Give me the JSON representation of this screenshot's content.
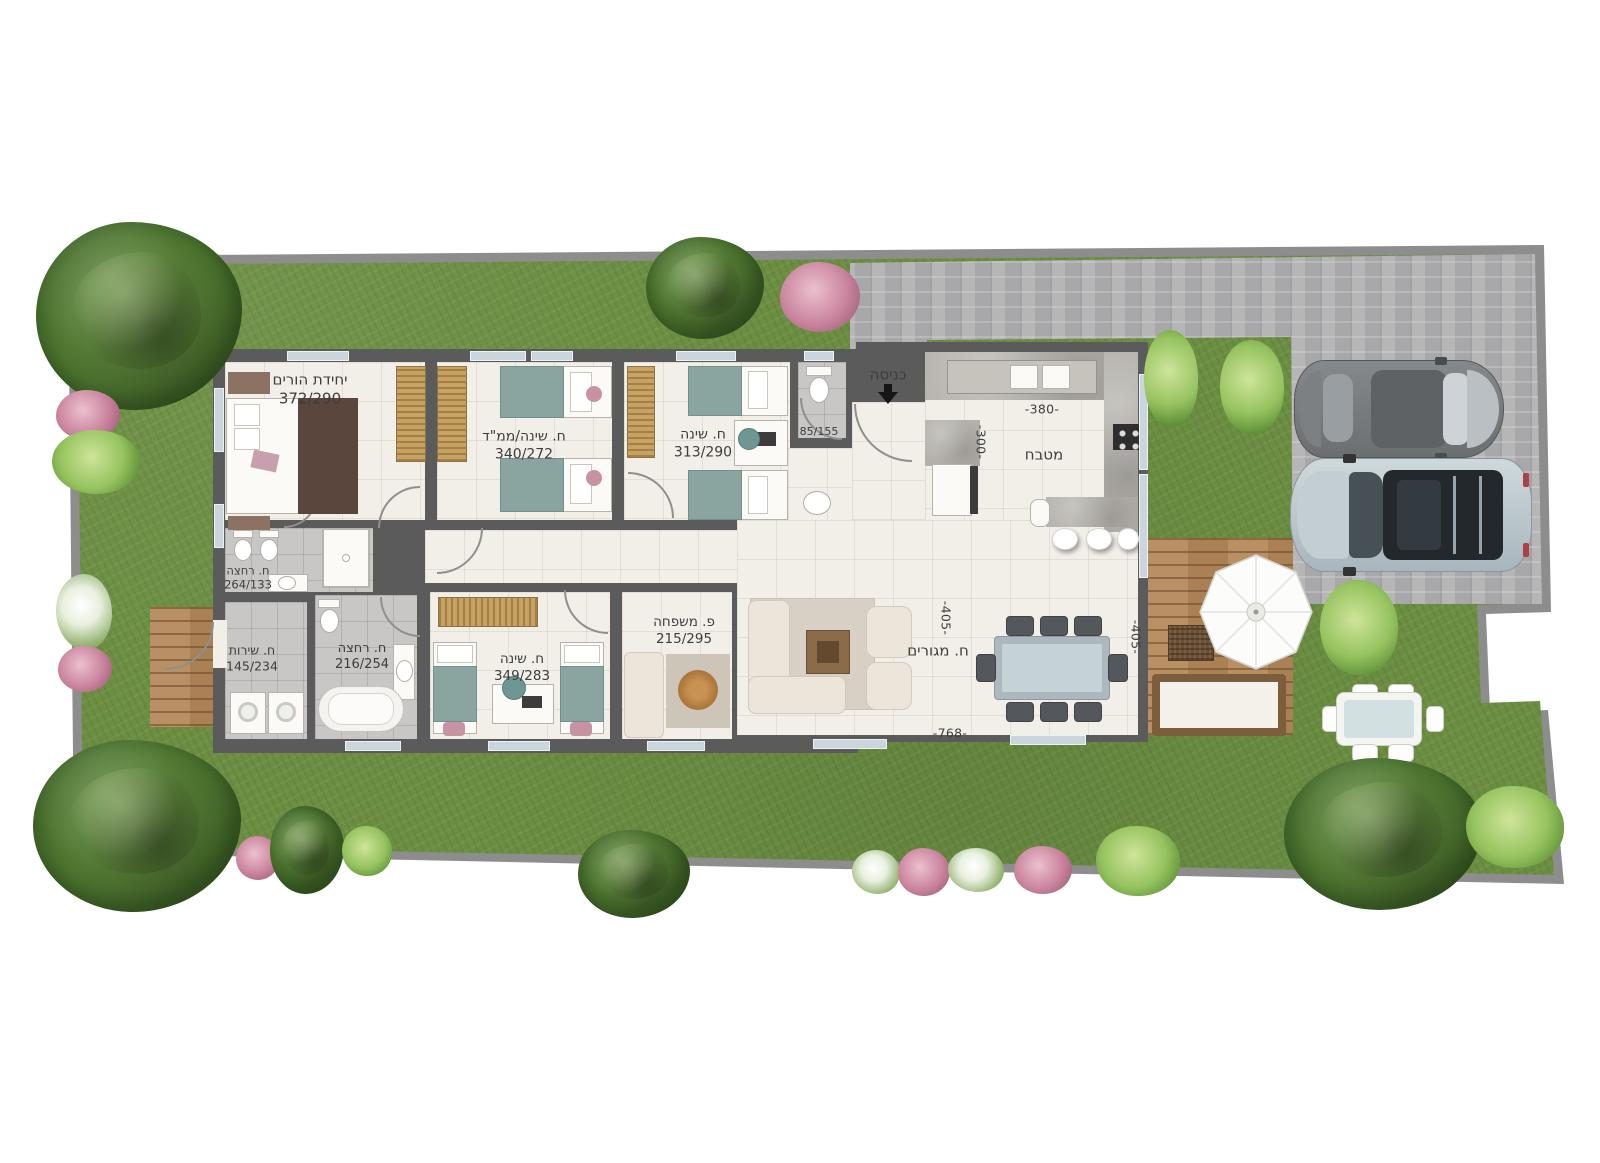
{
  "plan_type": "residential floor plan with garden, top-down render",
  "colors": {
    "grass": "#6b8e42",
    "paving": "#b1b1b3",
    "exterior_wall": "#5c5b5b",
    "boundary_wall": "#8d8d8d",
    "floor_tile": "#f2efe8",
    "wet_room_tile": "#c8c7c5",
    "deck_wood": "#b5895a"
  },
  "rooms": {
    "parents_unit": {
      "name": "יחידת הורים",
      "size": "372/290"
    },
    "safe_room_bedroom": {
      "name": "ח. שינה/ממ\"ד",
      "size": "340/272"
    },
    "bedroom_2": {
      "name": "ח. שינה",
      "size": "313/290"
    },
    "toilet": {
      "size": "85/155"
    },
    "entrance": {
      "name": "כניסה"
    },
    "kitchen": {
      "name": "מטבח"
    },
    "parents_bathroom": {
      "name": "ח. רחצה",
      "size": "264/133"
    },
    "utility_room": {
      "name": "ח. שירות",
      "size": "145/234"
    },
    "bathroom_2": {
      "name": "ח. רחצה",
      "size": "216/254"
    },
    "bedroom_3": {
      "name": "ח. שינה",
      "size": "349/283"
    },
    "family_corner": {
      "name": "פ. משפחה",
      "size": "215/295"
    },
    "living_room": {
      "name": "ח. מגורים"
    }
  },
  "dimensions": {
    "kitchen_width": "-380-",
    "entry_depth": "-300-",
    "living_depth_left": "-405-",
    "living_depth_right": "-405-",
    "living_width": "-768-"
  }
}
